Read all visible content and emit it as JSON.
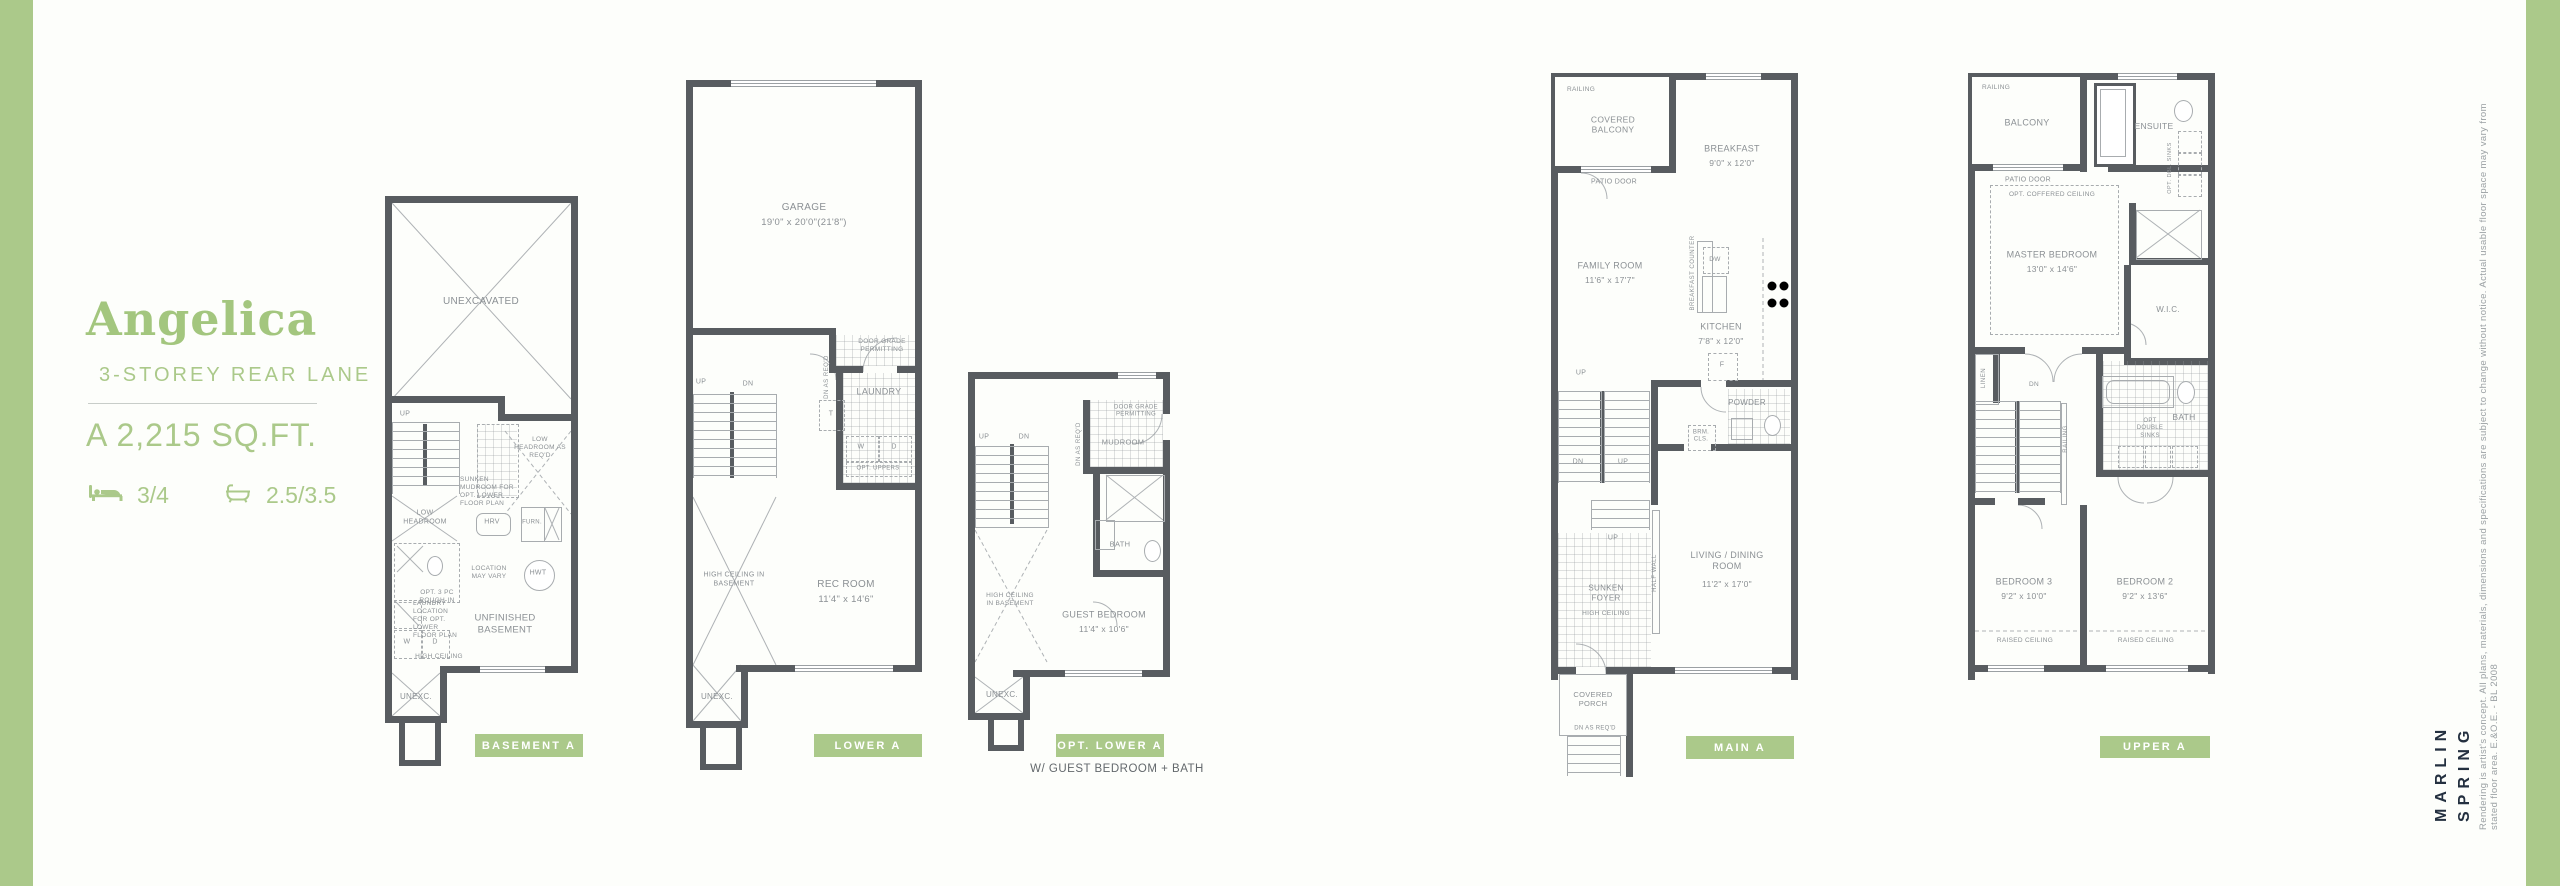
{
  "header": {
    "model_name": "Angelica",
    "model_type": "3-STOREY REAR LANE",
    "area": "A 2,215 SQ.FT.",
    "beds": "3/4",
    "baths": "2.5/3.5"
  },
  "colors": {
    "green": "#ABC98A",
    "green_text": "#A3C67E",
    "wall": "#585C60",
    "line": "#A8ACAF",
    "label": "#8B9094",
    "navy": "#243040"
  },
  "plans": {
    "basement": {
      "button": "BASEMENT A",
      "labels": {
        "unexcavated": "UNEXCAVATED",
        "up": "UP",
        "low_headroom": "LOW HEADROOM",
        "sunken_mudroom": "SUNKEN MUDROOM FOR OPT. LOWER FLOOR PLAN",
        "low_headroom_reqd": "LOW HEADROOM AS REQ'D",
        "hrv": "HRV",
        "furn": "FURN.",
        "opt_roughin": "OPT. 3 PC ROUGH-IN",
        "location_may_vary": "LOCATION MAY VARY",
        "hwt": "HWT",
        "unfinished_basement": "UNFINISHED BASEMENT",
        "laundry_location": "LAUNDRY LOCATION FOR OPT. LOWER FLOOR PLAN",
        "w": "W",
        "d": "D",
        "high_ceiling": "HIGH CEILING",
        "unexc": "UNEXC."
      }
    },
    "lower": {
      "button": "LOWER A",
      "labels": {
        "garage": "GARAGE",
        "garage_dims": "19'0\" x 20'0\"(21'8\")",
        "door_grade": "DOOR GRADE PERMITTING",
        "up": "UP",
        "dn": "DN",
        "dn_as_reqd": "DN AS REQ'D",
        "t": "T",
        "laundry": "LAUNDRY",
        "w": "W",
        "d": "D",
        "opt_uppers": "OPT. UPPERS",
        "high_ceiling_basement": "HIGH CEILING IN BASEMENT",
        "rec_room": "REC ROOM",
        "rec_room_dims": "11'4\" x 14'6\"",
        "unexc": "UNEXC."
      }
    },
    "optlower": {
      "button": "OPT. LOWER A",
      "caption": "W/ GUEST BEDROOM + BATH",
      "labels": {
        "door_grade": "DOOR GRADE PERMITTING",
        "mudroom": "MUDROOM",
        "dn_as_reqd": "DN AS REQ'D",
        "up": "UP",
        "dn": "DN",
        "bath": "BATH",
        "high_ceiling_basement": "HIGH CEILING IN BASEMENT",
        "guest_bedroom": "GUEST BEDROOM",
        "guest_bedroom_dims": "11'4\" x 10'6\"",
        "unexc": "UNEXC."
      }
    },
    "main": {
      "button": "MAIN A",
      "labels": {
        "railing": "RAILING",
        "covered_balcony": "COVERED BALCONY",
        "patio_door": "PATIO DOOR",
        "breakfast": "BREAKFAST",
        "breakfast_dims": "9'0\" x 12'0\"",
        "family_room": "FAMILY ROOM",
        "family_room_dims": "11'6\" x 17'7\"",
        "breakfast_counter": "BREAKFAST COUNTER",
        "dw": "DW",
        "kitchen": "KITCHEN",
        "kitchen_dims": "7'8\" x 12'0\"",
        "f": "F",
        "up": "UP",
        "dn": "DN",
        "up2": "UP",
        "up3": "UP",
        "powder": "POWDER",
        "brm_cls": "BRM. CLS.",
        "sunken_foyer": "SUNKEN FOYER",
        "high_ceiling": "HIGH CEILING",
        "half_wall": "HALF WALL",
        "living_dining": "LIVING / DINING ROOM",
        "living_dining_dims": "11'2\" x 17'0\"",
        "covered_porch": "COVERED PORCH",
        "dn_as_reqd": "DN AS REQ'D"
      }
    },
    "upper": {
      "button": "UPPER A",
      "labels": {
        "railing": "RAILING",
        "balcony": "BALCONY",
        "patio_door": "PATIO DOOR",
        "ensuite": "ENSUITE",
        "opt_dbl_sinks": "OPT. DBL. SINKS",
        "opt_coffered_ceiling": "OPT. COFFERED CEILING",
        "master_bedroom": "MASTER BEDROOM",
        "master_bedroom_dims": "13'0\" x 14'6\"",
        "wic": "W.I.C.",
        "linen": "LINEN",
        "dn": "DN",
        "railing2": "RAILING",
        "bath": "BATH",
        "opt_double_sinks": "OPT DOUBLE SINKS",
        "bedroom3": "BEDROOM 3",
        "bedroom3_dims": "9'2\" x 10'0\"",
        "bedroom2": "BEDROOM 2",
        "bedroom2_dims": "9'2\" x 13'6\"",
        "raised_ceiling": "RAISED CEILING",
        "raised_ceiling2": "RAISED CEILING"
      }
    }
  },
  "branding": {
    "logo_line1": "MARLIN",
    "logo_line2": "SPRING",
    "disclaimer": "Rendering is artist's concept. All plans, materials, dimensions and specifications are subject to change without notice. Actual usable floor space may vary from stated floor area. E.&O.E. - BL 2008"
  }
}
